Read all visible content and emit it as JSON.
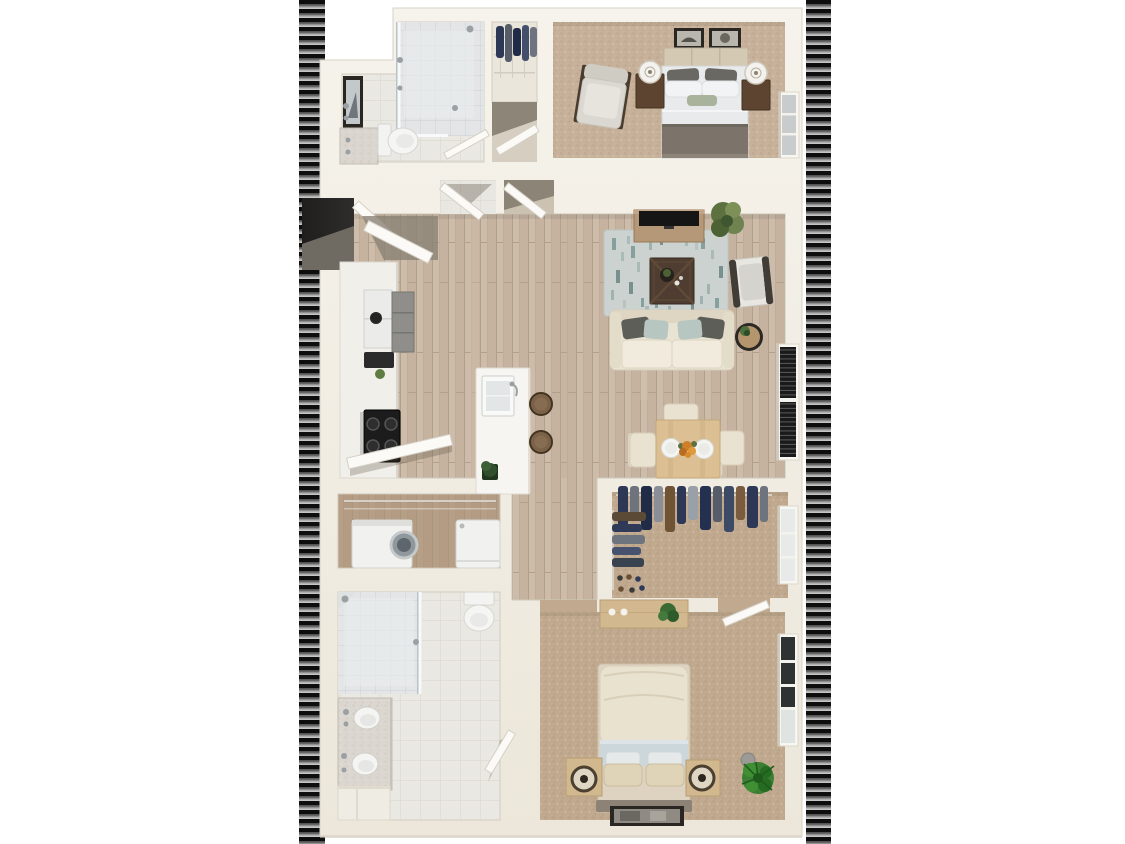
{
  "scene": {
    "type": "3d-floor-plan-render",
    "description": "Top-down 3D rendering of a one-bedroom-plus-den style apartment floor plan with two bedrooms, two bathrooms, open kitchen-living-dining area, laundry closet and walk-in closet; vertical glitch stripe bands run along the left and right edges of the render on a white background. No text is visible in the image.",
    "orientation": "portrait",
    "width_px": 1125,
    "height_px": 844
  },
  "palette": {
    "page_bg": "#ffffff",
    "stripe_black": "#0e0e0e",
    "stripe_gray_dark": "#4a4a4a",
    "stripe_gray_mid": "#8f8f8f",
    "stripe_gray_light": "#c6c6c6",
    "wall": "#f2eee5",
    "wall_shadow": "#d8d2c4",
    "wood_floor": "#c8b6a2",
    "wood_floor_dark": "#a98f74",
    "carpet_bedroom1": "#c7b19a",
    "carpet_bedroom2": "#c0a98e",
    "tile": "#eae8e2",
    "shower_tile": "#e3e5e6",
    "rug_base": "#ccd2d0",
    "rug_accent": "#86a09e",
    "sofa_cream": "#e9e3d3",
    "pillow_dark_gray": "#5e5e58",
    "pillow_teal": "#b7c6c1",
    "coffee_table_brown": "#4e3d30",
    "console_wood": "#b59878",
    "dining_wood": "#dcc094",
    "nightstand_dark_wood": "#5d4431",
    "light_wood": "#d2b88e",
    "tv_black": "#151515",
    "appliance_black": "#1c1c1c",
    "clothes_navy": "#2c3856",
    "plant_olive": "#5f7d42",
    "plant_green": "#2e7a2a",
    "blanket_taupe": "#7c746a",
    "duvet_cream": "#e9e2cf",
    "sheet_blue": "#ccd7dc",
    "door_white": "#fbfaf7",
    "entry_shadow": "#2e2d2b",
    "chrome": "#9aa0a3",
    "frame_dark": "#2a2622"
  },
  "rooms": [
    {
      "id": "bathroom-1",
      "name": "Bathroom 1",
      "position": "top-left",
      "features": [
        "walk-in glass shower",
        "toilet",
        "vanity with faucet",
        "framed wall art",
        "tiled floor"
      ]
    },
    {
      "id": "hall-closet",
      "name": "Hall Closet",
      "position": "top-center",
      "features": [
        "wire shelving",
        "hanging clothes"
      ]
    },
    {
      "id": "bedroom-1",
      "name": "Bedroom 1",
      "position": "top-right",
      "features": [
        "bed with gray and white bedding and taupe throw",
        "paneled headboard",
        "two dark wood nightstands",
        "two white drum lamps",
        "two framed artworks",
        "gray armchair",
        "window",
        "tan carpet"
      ]
    },
    {
      "id": "entry",
      "name": "Entry",
      "position": "left-middle",
      "features": [
        "front door ajar",
        "dark threshold recess"
      ]
    },
    {
      "id": "kitchen",
      "name": "Kitchen",
      "position": "left-middle",
      "features": [
        "counter run",
        "refrigerator",
        "gray upper cabinets",
        "black range with four burners",
        "open cabinet doors",
        "island with sink and faucet",
        "two barstools",
        "small plant"
      ]
    },
    {
      "id": "living-room",
      "name": "Living Room",
      "position": "center-right",
      "features": [
        "cream sofa with dark gray and teal pillows",
        "patterned area rug",
        "dark wood coffee table with decor tray",
        "media console with TV",
        "tall potted plant",
        "accent chair",
        "round side table with plant",
        "window with dark blinds",
        "hardwood flooring"
      ]
    },
    {
      "id": "dining-area",
      "name": "Dining Area",
      "position": "center-right-lower",
      "features": [
        "light wood dining table",
        "four cream chairs",
        "two place settings",
        "orange floral centerpiece"
      ]
    },
    {
      "id": "laundry-closet",
      "name": "Laundry Closet",
      "position": "left-lower",
      "features": [
        "washer",
        "dryer",
        "wire shelf",
        "dark wood floor"
      ]
    },
    {
      "id": "walk-in-closet",
      "name": "Walk-in Closet",
      "position": "right-lower",
      "features": [
        "hanging clothes on two walls",
        "wire shelving",
        "rows of shoes",
        "window",
        "tan carpet"
      ]
    },
    {
      "id": "bathroom-2",
      "name": "Bathroom 2",
      "position": "bottom-left",
      "features": [
        "walk-in glass shower",
        "double-sink vanity",
        "toilet",
        "tiled floor",
        "step bench",
        "door ajar"
      ]
    },
    {
      "id": "bedroom-2",
      "name": "Bedroom 2",
      "position": "bottom-right",
      "features": [
        "bed with cream duvet and blue sheet band",
        "two light wood nightstands with ring lamps",
        "dresser with plant and knobs",
        "framed photo art",
        "large green potted plant",
        "gray waste bin",
        "two windows",
        "door to walk-in closet",
        "tan carpet"
      ]
    }
  ],
  "decorations": {
    "left_stripe_band": {
      "style": "horizontal glitch slats",
      "x": 299,
      "width": 26
    },
    "right_stripe_band": {
      "style": "horizontal glitch slats",
      "x": 806,
      "width": 25
    }
  }
}
